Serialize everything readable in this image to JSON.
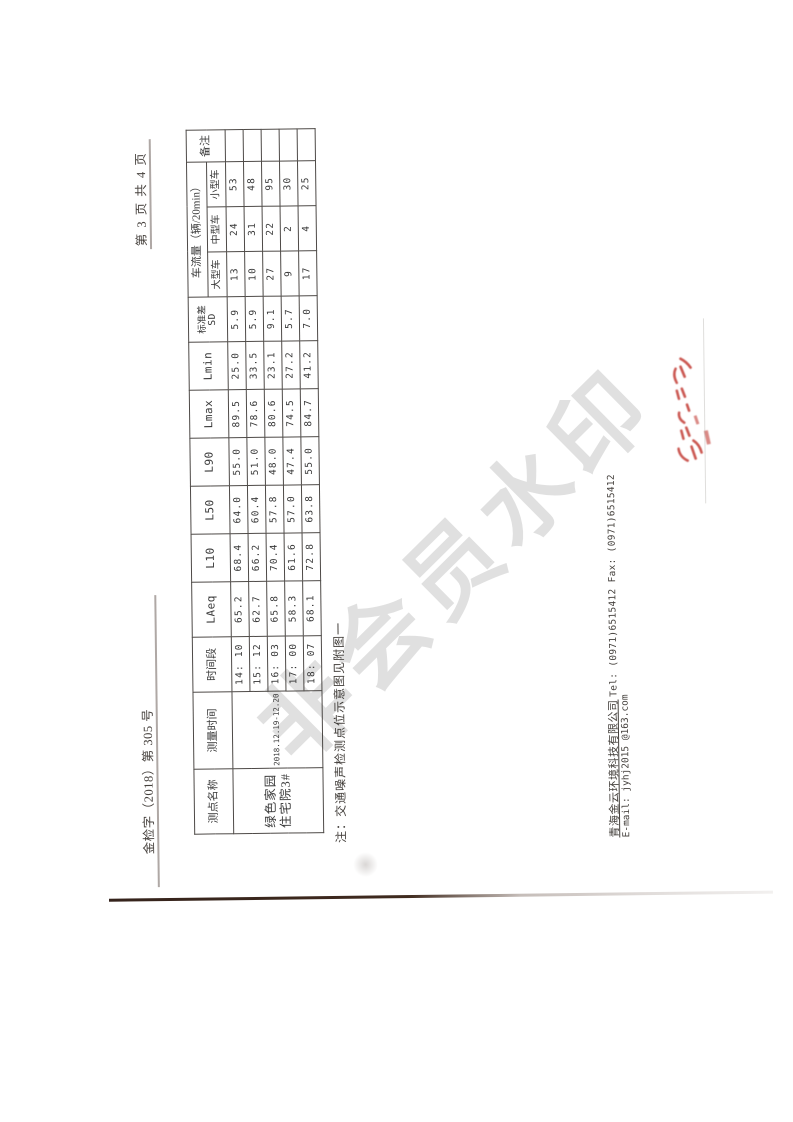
{
  "page": {
    "doc_number": "金检字（2018）第 305 号",
    "page_indicator": "第 3 页 共 4 页"
  },
  "table": {
    "headers": {
      "point_name": "测点名称",
      "measure_time": "测量时间",
      "time_period": "时间段",
      "laeq": "LAeq",
      "l10": "L10",
      "l50": "L50",
      "l90": "L90",
      "lmax": "Lmax",
      "lmin": "Lmin",
      "sd_line1": "标准差",
      "sd_line2": "SD",
      "traffic_group": "车流量（辆/20min）",
      "large": "大型车",
      "medium": "中型车",
      "small": "小型车",
      "remark": "备注"
    },
    "point_name_value_line1": "绿色家园",
    "point_name_value_line2": "住宅院3#",
    "measure_time_value": "2018.12.19-12.20",
    "rows": [
      {
        "time": "14: 10",
        "laeq": "65.2",
        "l10": "68.4",
        "l50": "64.0",
        "l90": "55.0",
        "lmax": "89.5",
        "lmin": "25.0",
        "sd": "5.9",
        "large": "13",
        "medium": "24",
        "small": "53",
        "remark": ""
      },
      {
        "time": "15: 12",
        "laeq": "62.7",
        "l10": "66.2",
        "l50": "60.4",
        "l90": "51.0",
        "lmax": "78.6",
        "lmin": "33.5",
        "sd": "5.9",
        "large": "10",
        "medium": "31",
        "small": "48",
        "remark": ""
      },
      {
        "time": "16: 03",
        "laeq": "65.8",
        "l10": "70.4",
        "l50": "57.8",
        "l90": "48.0",
        "lmax": "80.6",
        "lmin": "23.1",
        "sd": "9.1",
        "large": "27",
        "medium": "22",
        "small": "95",
        "remark": ""
      },
      {
        "time": "17: 00",
        "laeq": "58.3",
        "l10": "61.6",
        "l50": "57.0",
        "l90": "47.4",
        "lmax": "74.5",
        "lmin": "27.2",
        "sd": "5.7",
        "large": "9",
        "medium": "2",
        "small": "30",
        "remark": ""
      },
      {
        "time": "18: 07",
        "laeq": "68.1",
        "l10": "72.8",
        "l50": "63.8",
        "l90": "55.0",
        "lmax": "84.7",
        "lmin": "41.2",
        "sd": "7.0",
        "large": "17",
        "medium": "4",
        "small": "25",
        "remark": ""
      }
    ]
  },
  "note": "注：交通噪声检测点位示意图见附图一",
  "footer": {
    "company": "青海金云环境科技有限公司",
    "tel_fax": "Tel:  (0971)6515412   Fax:  (0971)6515412",
    "email": "E-mail: jyhj2015 @163.com"
  },
  "watermark": "非会员水印",
  "colors": {
    "seal_red": "#c23b34",
    "watermark_gray": "#c3c3c3",
    "table_line": "#4e4a47"
  }
}
